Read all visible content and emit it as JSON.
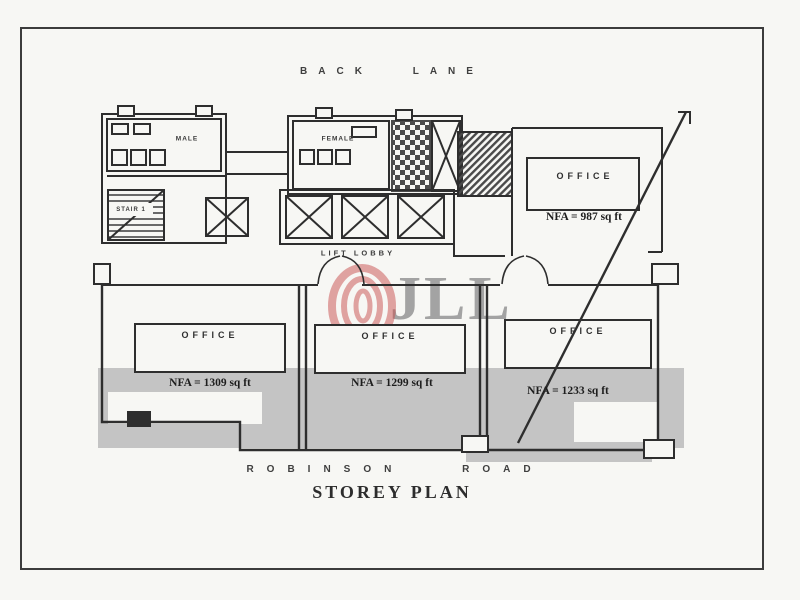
{
  "page": {
    "title": "STOREY PLAN"
  },
  "streets": {
    "top": "BACK LANE",
    "bottom": "ROBINSON ROAD"
  },
  "plan": {
    "rooms": {
      "male": "MALE",
      "female": "FEMALE",
      "stair1": "STAIR 1",
      "lift_lobby": "LIFT LOBBY"
    },
    "offices": [
      {
        "position": "top-right",
        "label": "OFFICE",
        "nfa": "NFA = 987 sq ft"
      },
      {
        "position": "bottom-left",
        "label": "OFFICE",
        "nfa": "NFA = 1309 sq ft"
      },
      {
        "position": "bottom-middle",
        "label": "OFFICE",
        "nfa": "NFA = 1299 sq ft"
      },
      {
        "position": "bottom-right",
        "label": "OFFICE",
        "nfa": "NFA = 1233 sq ft"
      }
    ],
    "icons": {
      "elevator": "elevator-x-icon",
      "stairs": "stair-hatch-icon",
      "door": "door-swing-icon",
      "logo": "jll-rings-icon"
    }
  },
  "watermark": {
    "text": "JLL",
    "logo_color": "#c94f4f",
    "text_color": "#8f8f8f",
    "band_color": "#c4c4c4"
  },
  "colors": {
    "ink": "#2e2e2e",
    "paper": "#f7f7f4"
  }
}
